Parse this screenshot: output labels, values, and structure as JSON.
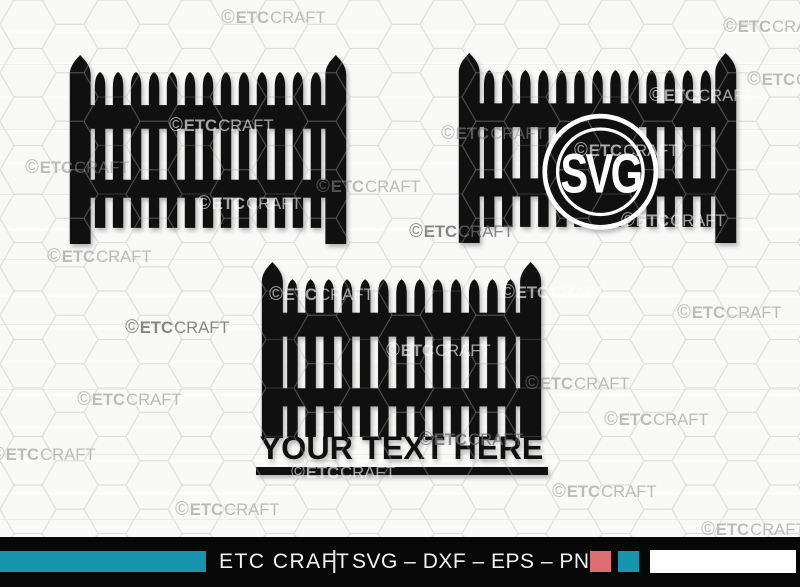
{
  "watermark": {
    "symbol": "©",
    "brand_bold": "ETC",
    "brand_light": "CRAFT"
  },
  "watermarks": [
    {
      "x": 220,
      "y": 8,
      "tone": "gray"
    },
    {
      "x": 722,
      "y": 17,
      "tone": "gray"
    },
    {
      "x": 746,
      "y": 70,
      "tone": "gray"
    },
    {
      "x": 648,
      "y": 86,
      "tone": "white"
    },
    {
      "x": 168,
      "y": 116,
      "tone": "white"
    },
    {
      "x": 440,
      "y": 124,
      "tone": "gray"
    },
    {
      "x": 573,
      "y": 141,
      "tone": "white"
    },
    {
      "x": 24,
      "y": 158,
      "tone": "gray"
    },
    {
      "x": 315,
      "y": 177,
      "tone": "gray"
    },
    {
      "x": 196,
      "y": 194,
      "tone": "white"
    },
    {
      "x": 620,
      "y": 211,
      "tone": "white"
    },
    {
      "x": 408,
      "y": 222,
      "tone": "dark"
    },
    {
      "x": 46,
      "y": 247,
      "tone": "gray"
    },
    {
      "x": 268,
      "y": 285,
      "tone": "white"
    },
    {
      "x": 500,
      "y": 283,
      "tone": "white"
    },
    {
      "x": 676,
      "y": 303,
      "tone": "gray"
    },
    {
      "x": 124,
      "y": 318,
      "tone": "dark"
    },
    {
      "x": 385,
      "y": 341,
      "tone": "white"
    },
    {
      "x": 524,
      "y": 374,
      "tone": "gray"
    },
    {
      "x": 76,
      "y": 390,
      "tone": "gray"
    },
    {
      "x": 603,
      "y": 410,
      "tone": "gray"
    },
    {
      "x": 418,
      "y": 430,
      "tone": "dark"
    },
    {
      "x": -10,
      "y": 445,
      "tone": "gray"
    },
    {
      "x": 290,
      "y": 463,
      "tone": "white"
    },
    {
      "x": 551,
      "y": 482,
      "tone": "gray"
    },
    {
      "x": 174,
      "y": 500,
      "tone": "gray"
    },
    {
      "x": 700,
      "y": 520,
      "tone": "gray"
    }
  ],
  "monogram": {
    "label": "SVG"
  },
  "split_fence": {
    "text": "YOUR TEXT HERE"
  },
  "footer": {
    "brand": "ETC CRAFT",
    "divider": "|",
    "formats": "SVG – DXF – EPS – PNG",
    "accent_teal": "#1795AE",
    "accent_salmon": "#DF6E73",
    "accent_white": "#FFFFFF",
    "bar_bg": "#070707"
  },
  "background": {
    "hex_line": "#d9d9d7",
    "fence_color": "#101010"
  }
}
